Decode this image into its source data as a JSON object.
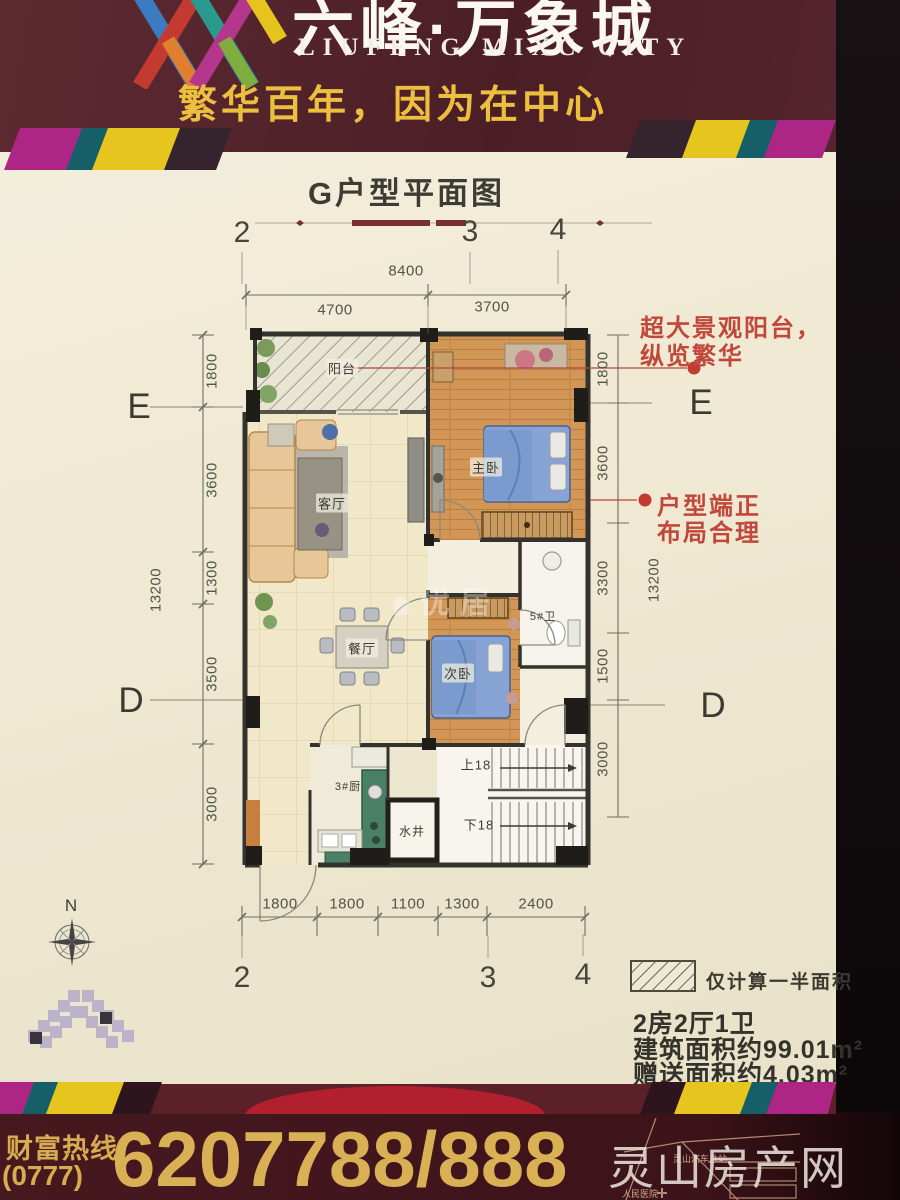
{
  "header": {
    "brand": "六峰·万象城",
    "brand_en": "LIUFENG MIXC CITY",
    "slogan": "繁华百年，因为在中心"
  },
  "plan": {
    "title": "G户型平面图",
    "grid_top": [
      "2",
      "3",
      "4"
    ],
    "grid_bottom": [
      "2",
      "3",
      "4"
    ],
    "grid_left": [
      "E",
      "D"
    ],
    "grid_right": [
      "E",
      "D"
    ],
    "dim_top_total": "8400",
    "dim_top": [
      "4700",
      "3700"
    ],
    "dim_left_total": "13200",
    "dim_left": [
      "1800",
      "3600",
      "1300",
      "3500",
      "3000"
    ],
    "dim_right_total": "13200",
    "dim_right": [
      "1800",
      "3600",
      "3300",
      "1500",
      "3000"
    ],
    "dim_bottom": [
      "1800",
      "1800",
      "1100",
      "1300",
      "2400"
    ],
    "rooms": {
      "balcony": "阳台",
      "living": "客厅",
      "dining": "餐厅",
      "master": "主卧",
      "second": "次卧",
      "bath": "5#卫",
      "kitchen": "3#厨",
      "shaft": "水井",
      "stairs_up": "上18",
      "stairs_down": "下18"
    },
    "note_balcony": [
      "超大景观阳台，",
      "纵览繁华"
    ],
    "note_layout": [
      "户型端正",
      "布局合理"
    ],
    "compass": "N",
    "watermark": "优居"
  },
  "legend": {
    "hatch_note": "仅计算一半面积",
    "unit_type": "2房2厅1卫",
    "area_built": "建筑面积约99.01m²",
    "area_gift": "赠送面积约4.03m²"
  },
  "footer": {
    "hotline_label": "财富热线",
    "area_code": "(0777)",
    "phone": "6207788/888",
    "map_station": "灵山汽车总站",
    "map_hospital": "人民医院",
    "site_watermark": "灵山房产网"
  },
  "colors": {
    "maroon": "#53232b",
    "gold": "#e0b44e",
    "cream": "#efe9d4",
    "note_red": "#c1473a",
    "bed_blue": "#87a3d4",
    "wood": "#d29657",
    "counter_green": "#4a8066"
  }
}
